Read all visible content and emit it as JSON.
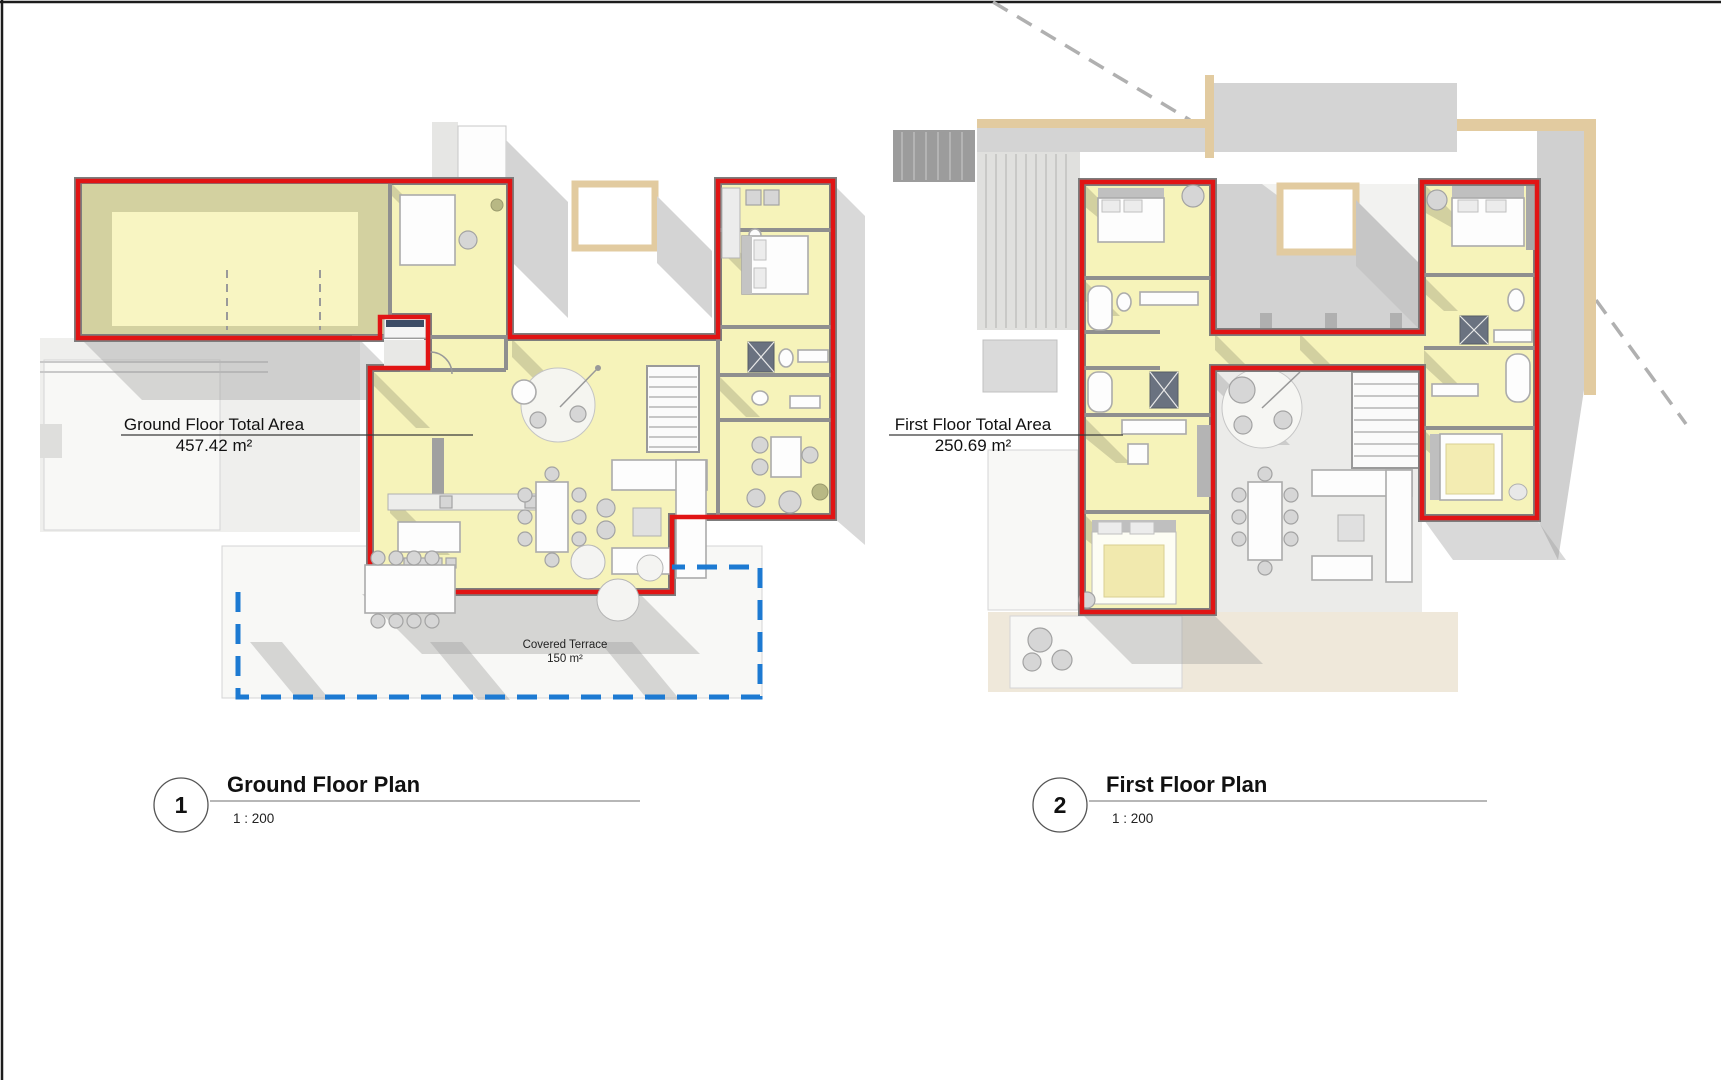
{
  "sheet": {
    "width_px": 1721,
    "height_px": 1080,
    "background": "#ffffff",
    "border_color": "#1c1c1c"
  },
  "colors": {
    "boundary_red": "#e11414",
    "terrace_blue": "#1d7ad2",
    "floor_yellow": "#f6f3ba",
    "roof_tan": "#e2cba0",
    "wall_gray": "#8f8f8f",
    "shadow_gray": "#bcbcbc",
    "cream": "#efe8da"
  },
  "plans": [
    {
      "number": "1",
      "title": "Ground Floor Plan",
      "scale_label": "1 : 200",
      "area_label": "Ground Floor Total Area",
      "area_value": "457.42 m²",
      "terrace": {
        "label": "Covered Terrace",
        "area": "150 m²"
      }
    },
    {
      "number": "2",
      "title": "First Floor Plan",
      "scale_label": "1 : 200",
      "area_label": "First Floor Total Area",
      "area_value": "250.69 m²"
    }
  ]
}
